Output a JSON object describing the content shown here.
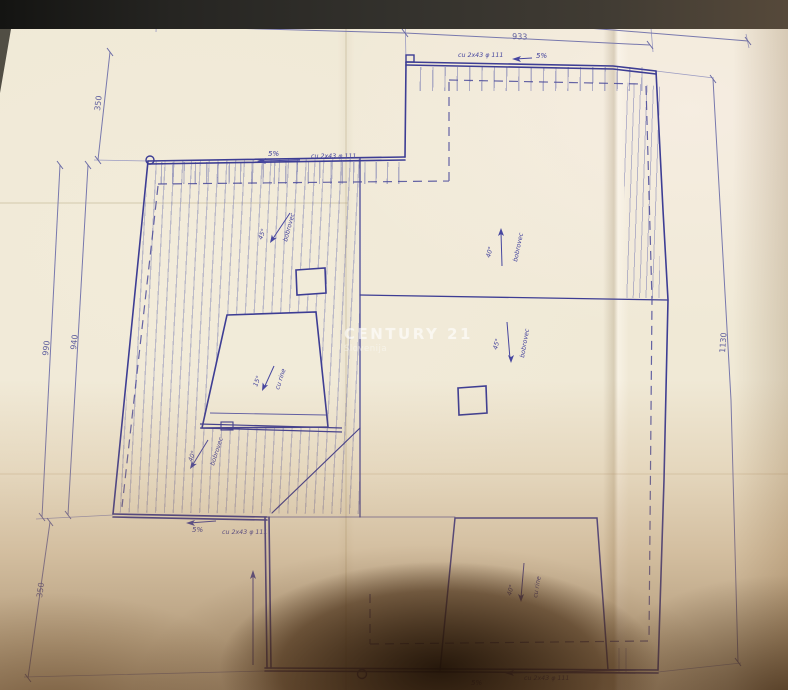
{
  "photo": {
    "watermark": {
      "brand": "CENTURY 21",
      "region": "Slovenija"
    }
  },
  "plan": {
    "type": "hand-drawn roof plan (blueprint, blue ink on folded paper)",
    "colors": {
      "ink": "#3d3d94",
      "paper": "#f0e9d6"
    },
    "dim_labels": {
      "top_total": "1045",
      "top_left": "300",
      "top_right": "933",
      "left_upper": "350",
      "left_outer": "990",
      "left_inner": "940",
      "left_lower": "350",
      "right_total": "1130"
    },
    "eaves": [
      {
        "edge": "top-left",
        "slope": "5%",
        "gutter": "cu 2x43 φ 111"
      },
      {
        "edge": "top-right",
        "slope": "5%",
        "gutter": "cu 2x43 φ 111"
      },
      {
        "edge": "lower-left",
        "slope": "5%",
        "gutter": "cu 2x43 φ 111"
      },
      {
        "edge": "bottom",
        "slope": "5%",
        "gutter": "cu 2x43 φ 111"
      }
    ],
    "slopes": [
      {
        "area": "upper-left-roof",
        "angle": "45°",
        "material": "bobrovec"
      },
      {
        "area": "upper-right-roof",
        "angle": "40°",
        "material": "bobrovec"
      },
      {
        "area": "middle-right-roof",
        "angle": "45°",
        "material": "bobrovec"
      },
      {
        "area": "lower-left-roof",
        "angle": "40°",
        "material": "bobrovec"
      },
      {
        "area": "dormer-terrace",
        "angle": "15°",
        "material": "cu rine"
      },
      {
        "area": "bottom-dormer",
        "angle": "40°",
        "material": "cu rine"
      }
    ]
  }
}
